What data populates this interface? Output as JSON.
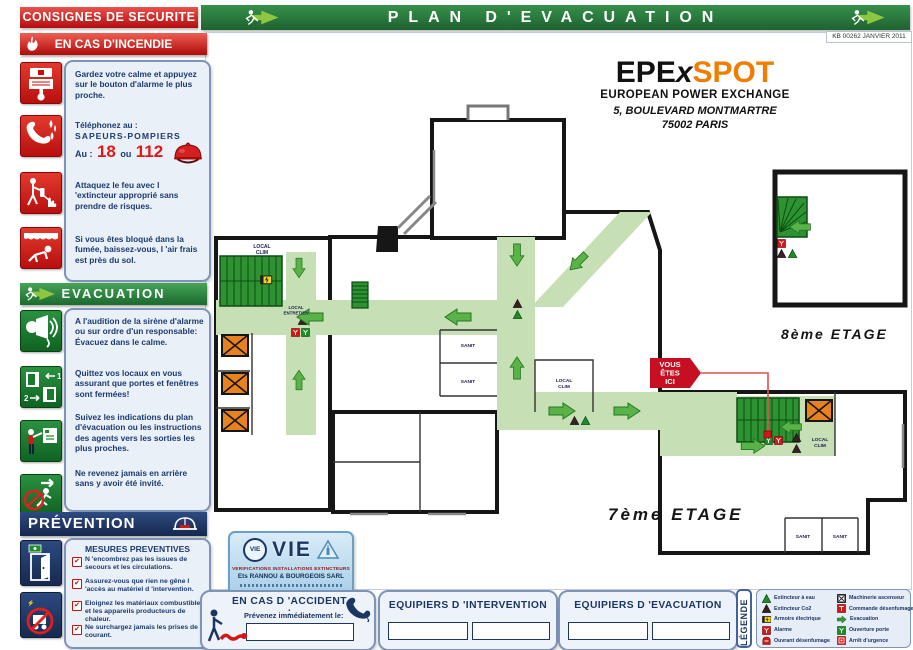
{
  "header": {
    "consignes_label": "CONSIGNES DE SECURITE",
    "title": "PLAN D'EVACUATION",
    "doc_ref": "KB 00262 JANVIER 2011"
  },
  "incendie": {
    "banner": "EN CAS D'INCENDIE",
    "item1": "Gardez votre calme et appuyez sur le bouton d'alarme le plus proche.",
    "tel_intro": "Téléphonez au :",
    "tel_who": "SAPEURS-POMPIERS",
    "tel_au": "Au :",
    "tel_num1": "18",
    "tel_ou": "ou",
    "tel_num2": "112",
    "item3": "Attaquez le feu avec l 'extincteur approprié sans prendre de risques.",
    "item4": "Si vous êtes bloqué dans la fumée, baissez-vous, l 'air frais est près du sol."
  },
  "evacuation": {
    "banner": "EVACUATION",
    "item1": "A l'audition de la sirène d'alarme ou sur ordre d'un responsable: Évacuez dans le calme.",
    "item2": "Quittez vos locaux en vous assurant que portes et fenêtres sont fermées!",
    "item3": "Suivez les indications du plan d'évacuation ou les instructions des agents vers les sorties les plus proches.",
    "item4": "Ne revenez jamais en arrière sans y avoir été invité.",
    "door_step1": "1",
    "door_step2": "2"
  },
  "prevention": {
    "banner": "PRÉVENTION",
    "subtitle": "MESURES PREVENTIVES",
    "item1": "N 'encombrez pas les issues de secours et les circulations.",
    "item2": "Assurez-vous que rien ne gêne l 'accès au matériel d 'intervention.",
    "item3": "Eloignez les matériaux combustibles et les appareils producteurs de chaleur.",
    "item4": "Ne surchargez jamais les prises de courant.",
    "check": "✔"
  },
  "logo": {
    "part1": "EPE",
    "part2": "x",
    "part3": "SPOT",
    "subtitle": "EUROPEAN POWER EXCHANGE",
    "address_line1": "5, BOULEVARD MONTMARTRE",
    "address_line2": "75002 PARIS"
  },
  "plan": {
    "floor7_label": "7ème ETAGE",
    "floor8_label": "8ème ETAGE",
    "marker_line1": "VOUS",
    "marker_line2": "ÊTES",
    "marker_line3": "ICI",
    "room_local": "LOCAL",
    "room_clim": "CLIM",
    "room_sanit": "SANIT",
    "room_entretien": "ENTRETIEN"
  },
  "stamp": {
    "brand": "VIE",
    "tagline": "VERIFICATIONS INSTALLATIONS EXTINCTEURS",
    "company": "Ets RANNOU & BOURGEOIS SARL"
  },
  "accident": {
    "title": "EN CAS D 'ACCIDENT :",
    "subtitle": "Prévenez immédiatement le:"
  },
  "teams": {
    "intervention_title": "EQUIPIERS D 'INTERVENTION",
    "evacuation_title": "EQUIPIERS D 'EVACUATION"
  },
  "legend": {
    "tab": "LÉGENDE",
    "left": [
      {
        "label": "Extincteur à eau"
      },
      {
        "label": "Extincteur Co2"
      },
      {
        "label": "Armoire électrique"
      },
      {
        "label": "Alarme"
      },
      {
        "label": "Ouvrant désenfumage"
      }
    ],
    "right": [
      {
        "label": "Machinerie ascenseur"
      },
      {
        "label": "Commande désenfumage"
      },
      {
        "label": "Evacuation"
      },
      {
        "label": "Ouverture porte"
      },
      {
        "label": "Arrêt d'urgence"
      }
    ]
  },
  "colors": {
    "banner_red": "#cf1a1a",
    "banner_green": "#2b7a3d",
    "navy": "#1b3665",
    "accent_orange": "#ef7d00",
    "corridor_green": "#c6dfb5",
    "stair_green": "#2f9232",
    "elevator_orange": "#e8821e",
    "arrow_green": "#55b345",
    "alert_red": "#d01818"
  }
}
